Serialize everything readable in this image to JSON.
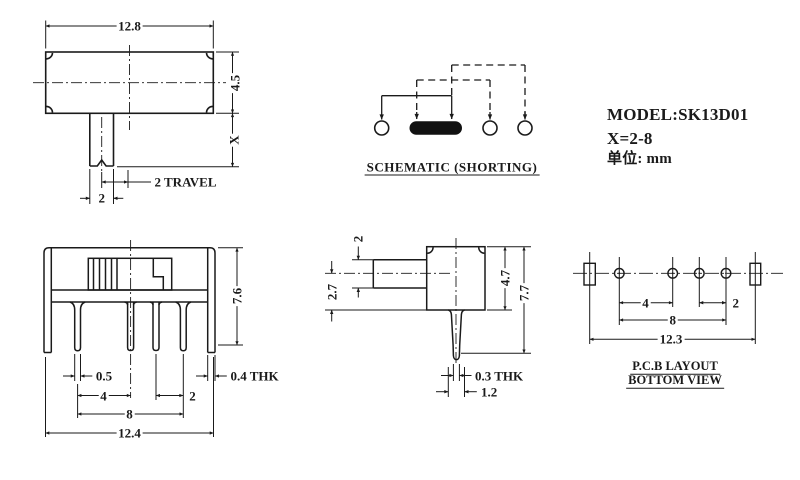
{
  "drawing": {
    "info": {
      "model": "MODEL:SK13D01",
      "x_range": "X=2-8",
      "unit": "单位: mm"
    },
    "schematic": {
      "label": "SCHEMATIC (SHORTING)"
    },
    "top_view": {
      "width": "12.8",
      "height": "4.5",
      "stem_length": "X",
      "travel": "2 TRAVEL",
      "stem_width": "2"
    },
    "front_view": {
      "height": "7.6",
      "pin_width": "0.5",
      "pitch_inner": "4",
      "pitch_right": "2",
      "pitch_outer": "8",
      "overall_width": "12.4",
      "bracket_thickness": "0.4 THK"
    },
    "side_view": {
      "stem_height": "2",
      "stem_center_offset": "2.7",
      "body_height": "4.7",
      "overall_height": "7.7",
      "pin_thickness": "0.3 THK",
      "pin_width": "1.2"
    },
    "pcb_view": {
      "pitch_inner": "4",
      "pitch_right": "2",
      "pitch_outer": "8",
      "hole_span": "12.3",
      "label_line1": "P.C.B LAYOUT",
      "label_line2": "BOTTOM VIEW"
    }
  },
  "colors": {
    "line": "#1a1a1a",
    "background": "#ffffff"
  }
}
